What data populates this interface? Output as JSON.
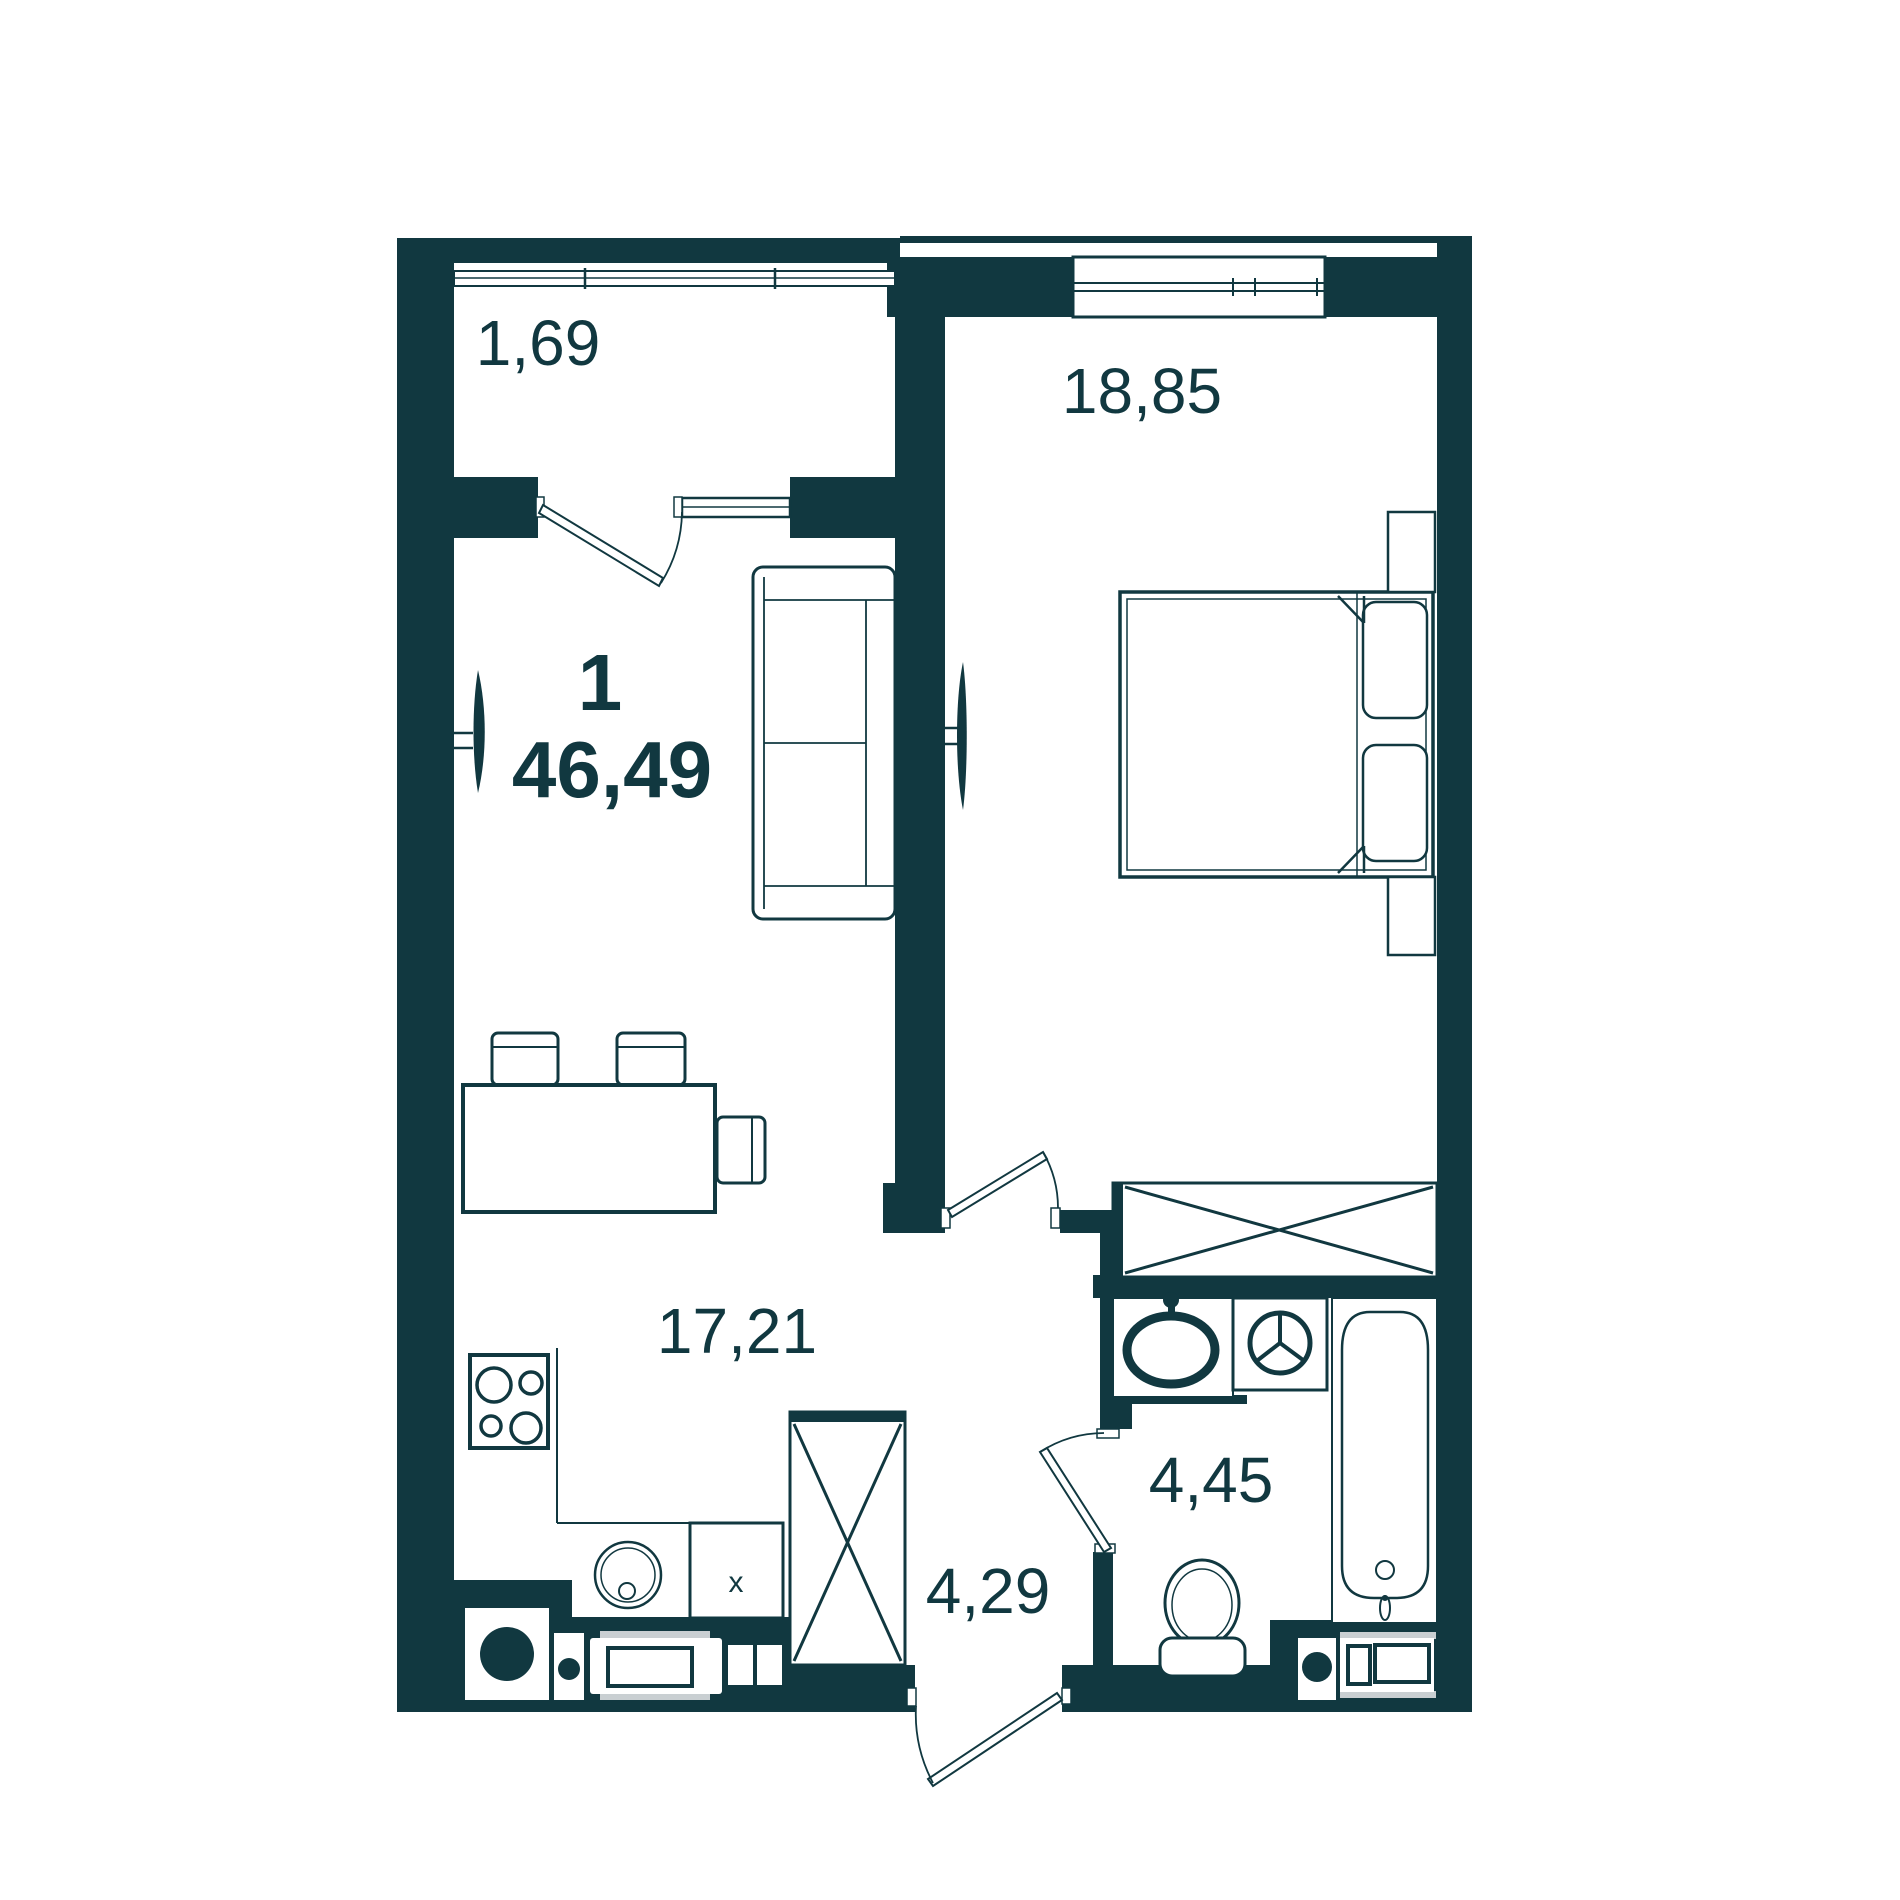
{
  "page": {
    "title": "1-room apartment floor plan"
  },
  "plan": {
    "rooms_count": "1",
    "total_area": "46,49",
    "rooms": [
      {
        "id": "balcony",
        "area": "1,69"
      },
      {
        "id": "bedroom",
        "area": "18,85"
      },
      {
        "id": "kitchen-living",
        "area": "17,21"
      },
      {
        "id": "bathroom",
        "area": "4,45"
      },
      {
        "id": "hallway",
        "area": "4,29"
      }
    ],
    "marks": {
      "cabinet": "x"
    },
    "colors": {
      "walls": "#113840",
      "background": "#FFFFFF",
      "accent_gray": "#C9CFD2"
    }
  }
}
